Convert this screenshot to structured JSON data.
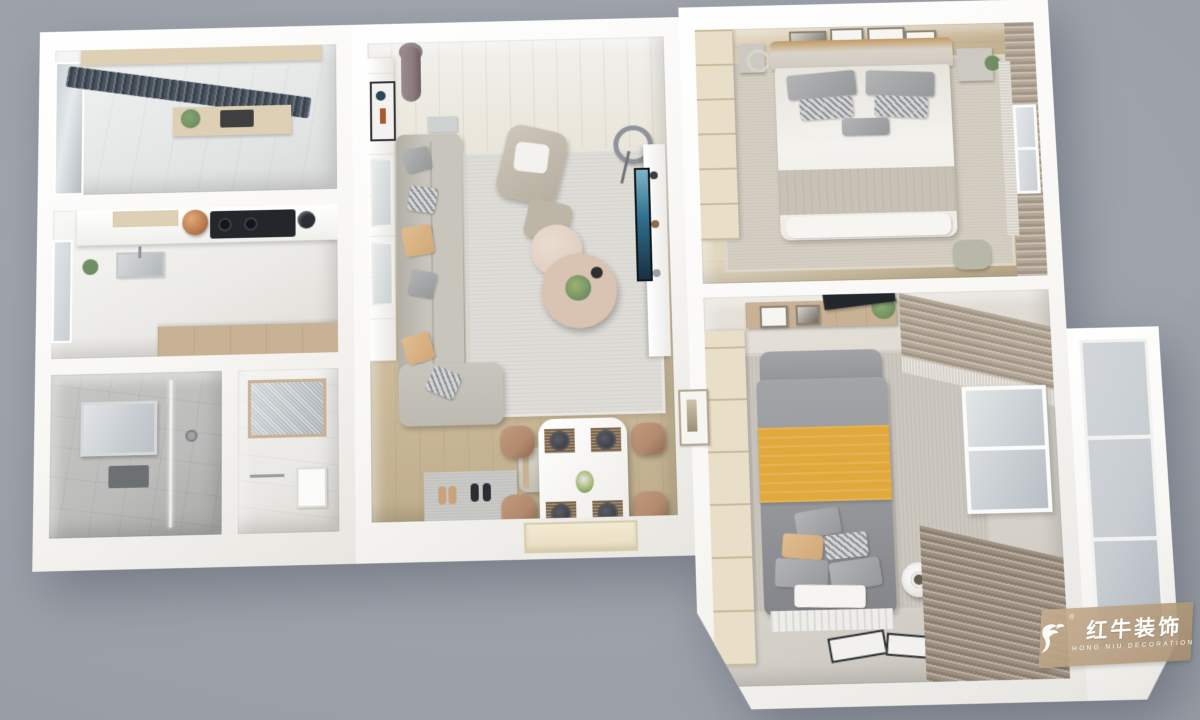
{
  "image": {
    "type": "3d-floorplan-render",
    "description": "Top-down 3D cutaway render of a furnished two-bedroom apartment on a gray backdrop"
  },
  "watermark": {
    "brand_cn": "红牛装饰",
    "brand_en": "HONG NIU DECORATION",
    "registered_mark": "®",
    "logo_icon": "bull-icon"
  },
  "palette": {
    "bg": "#9da2ab",
    "wall": "#f8f7f4",
    "wood": "#cfbe9f",
    "rug": "#dedcd7",
    "sofa": "#c8c5bd",
    "pillow-tan": "#d2a878",
    "yellow": "#e1a93c",
    "curtain": "#b3a695",
    "dark-curtain": "#4a5460",
    "glass": "#c8cdd2",
    "tile": "#bcbcba",
    "cream-cab": "#e9dfc8",
    "tv-screen": "#2e6e8c",
    "copper": "#b97a4e",
    "green": "#6f8f62",
    "chair-tan": "#b18a6f",
    "watermark-tan": "#b49a7d"
  },
  "scene": {
    "rooms": [
      {
        "name": "north-balcony-utility"
      },
      {
        "name": "kitchen"
      },
      {
        "name": "bathroom-shower"
      },
      {
        "name": "bathroom-vanity"
      },
      {
        "name": "living-dining-room"
      },
      {
        "name": "master-bedroom"
      },
      {
        "name": "second-bedroom"
      },
      {
        "name": "south-balcony"
      }
    ]
  }
}
